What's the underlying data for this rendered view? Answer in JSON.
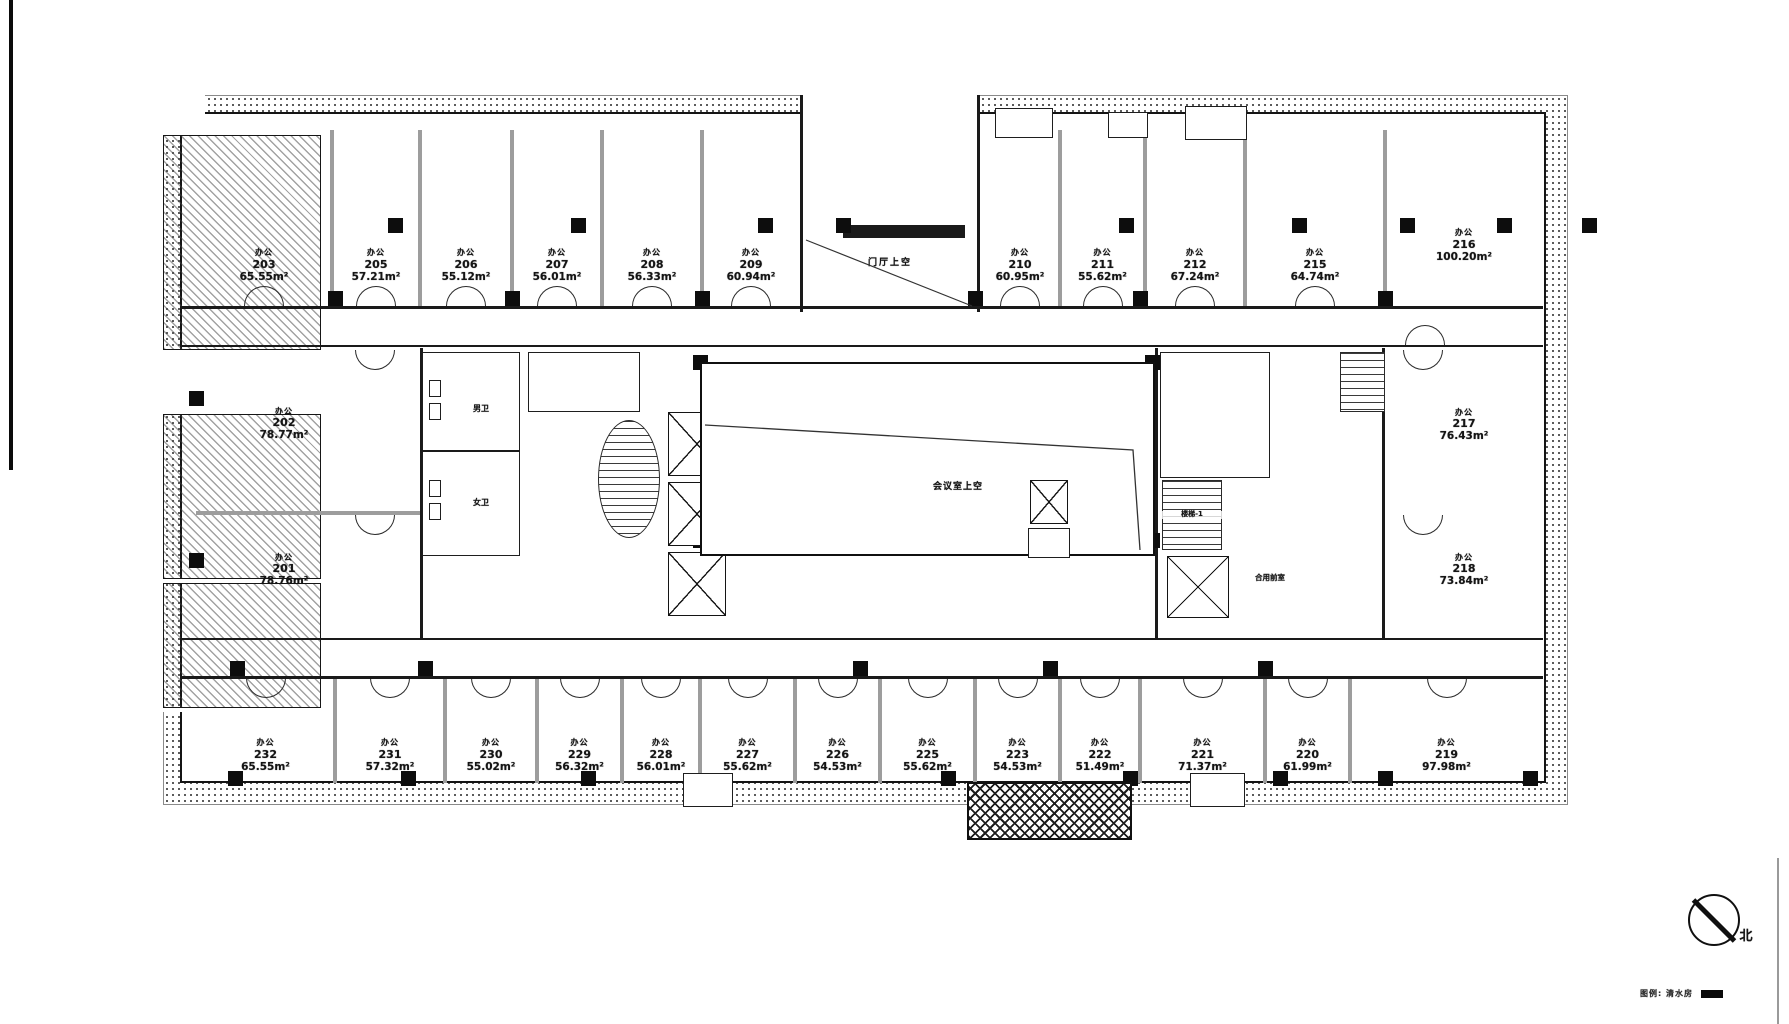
{
  "drawing": {
    "unit_type_label": "办公",
    "rooms": {
      "top": [
        {
          "number": "203",
          "area": "65.55m²"
        },
        {
          "number": "205",
          "area": "57.21m²"
        },
        {
          "number": "206",
          "area": "55.12m²"
        },
        {
          "number": "207",
          "area": "56.01m²"
        },
        {
          "number": "208",
          "area": "56.33m²"
        },
        {
          "number": "209",
          "area": "60.94m²"
        },
        {
          "number": "210",
          "area": "60.95m²"
        },
        {
          "number": "211",
          "area": "55.62m²"
        },
        {
          "number": "212",
          "area": "67.24m²"
        },
        {
          "number": "215",
          "area": "64.74m²"
        },
        {
          "number": "216",
          "area": "100.20m²"
        }
      ],
      "middle_left": [
        {
          "number": "202",
          "area": "78.77m²"
        },
        {
          "number": "201",
          "area": "78.76m²"
        }
      ],
      "middle_right": [
        {
          "number": "217",
          "area": "76.43m²"
        },
        {
          "number": "218",
          "area": "73.84m²"
        }
      ],
      "bottom": [
        {
          "number": "232",
          "area": "65.55m²"
        },
        {
          "number": "231",
          "area": "57.32m²"
        },
        {
          "number": "230",
          "area": "55.02m²"
        },
        {
          "number": "229",
          "area": "56.32m²"
        },
        {
          "number": "228",
          "area": "56.01m²"
        },
        {
          "number": "227",
          "area": "55.62m²"
        },
        {
          "number": "226",
          "area": "54.53m²"
        },
        {
          "number": "225",
          "area": "55.62m²"
        },
        {
          "number": "223",
          "area": "54.53m²"
        },
        {
          "number": "222",
          "area": "51.49m²"
        },
        {
          "number": "221",
          "area": "71.37m²"
        },
        {
          "number": "220",
          "area": "61.99m²"
        },
        {
          "number": "219",
          "area": "97.98m²"
        }
      ]
    },
    "core_labels": {
      "entrance_void": "门厅上空",
      "hall_void": "会议室上空",
      "shared_front_room": "合用前室",
      "stair_1": "楼梯-1",
      "mens_toilet": "男卫",
      "womens_toilet": "女卫"
    },
    "compass": {
      "north_label": "北"
    },
    "legend": {
      "text": "图例: 清水房"
    },
    "colors": {
      "ink": "#1a1a1a",
      "partition_gray": "#9d9d9d"
    }
  }
}
